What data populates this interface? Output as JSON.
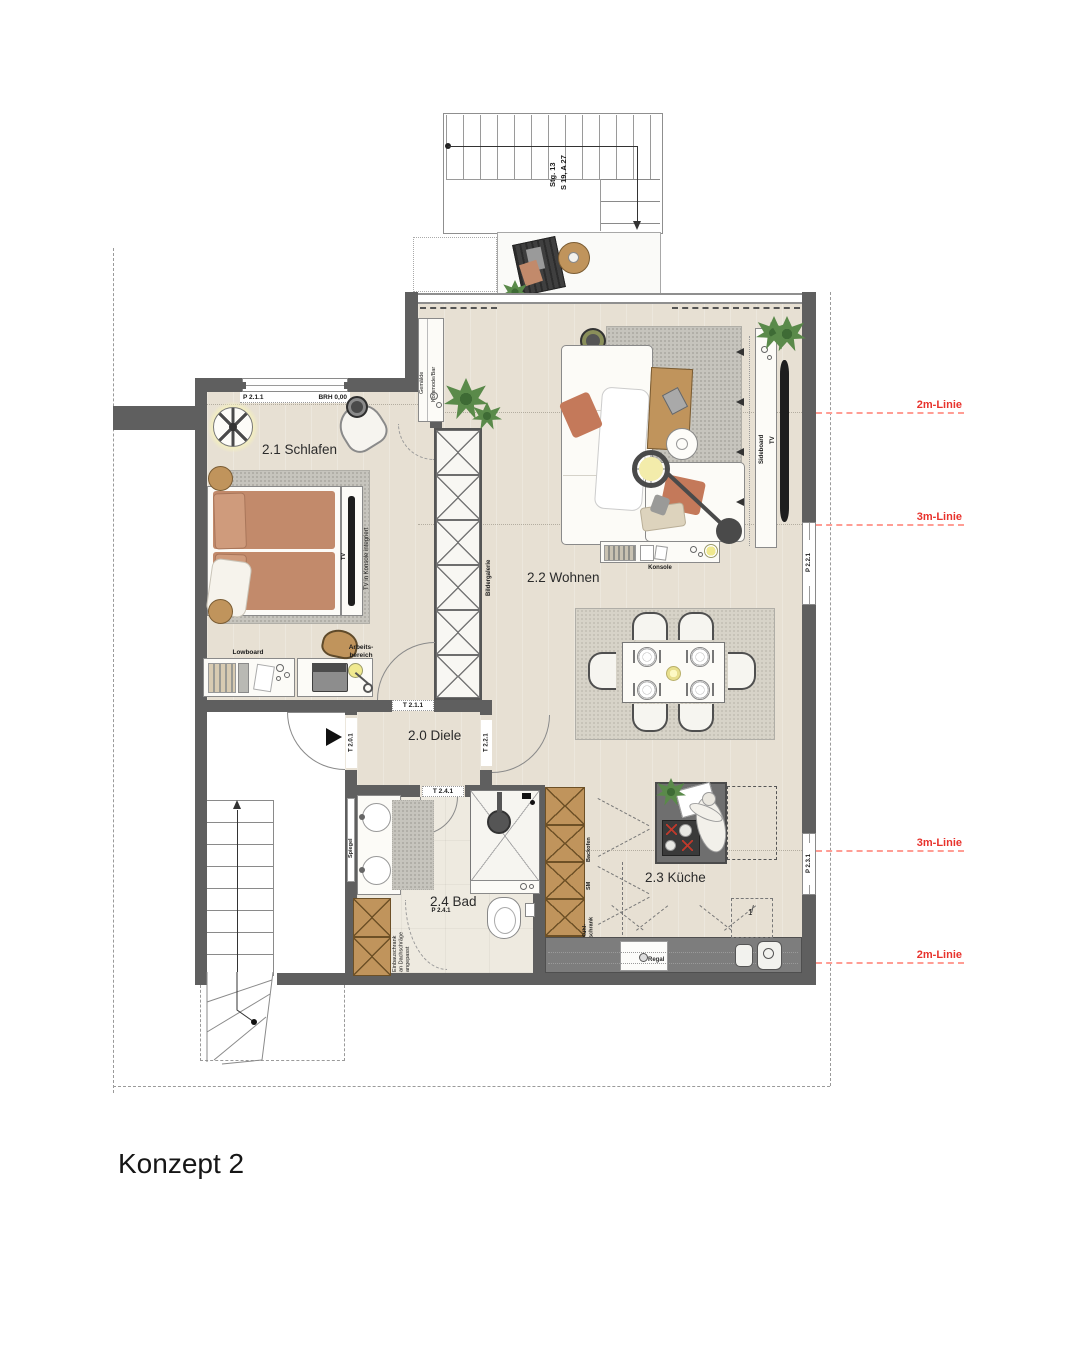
{
  "title": "Konzept 2",
  "rooms": {
    "schlafen": "2.1 Schlafen",
    "wohnen": "2.2 Wohnen",
    "diele": "2.0 Diele",
    "bad": "2.4 Bad",
    "kueche": "2.3 Küche"
  },
  "doors": {
    "t201": "T 2.0.1",
    "t211": "T 2.1.1",
    "t221": "T 2.2.1",
    "t241": "T 2.4.1"
  },
  "windows": {
    "p211": "P 2.1.1",
    "brh": "BRH 0,00",
    "p221": "P 2.2.1",
    "p231": "P 2.3.1",
    "p241": "P 2.4.1"
  },
  "stair": {
    "line1": "Stg. 13",
    "line2": "S 19, A 27"
  },
  "furniture": {
    "lowboard": "Lowboard",
    "arbeitsbereich": "Arbeits-\nbereich",
    "tv": "TV",
    "tv_wand": "TV",
    "tv_konsole": "TV in Konsole integriert",
    "bildergalerie": "Bildergalerie",
    "gemaelde": "Gemälde",
    "kommode_bar": "Kommode/Bar",
    "sideboard": "Sideboard",
    "konsole": "Konsole",
    "spiegel": "Spiegel",
    "regal": "Regal",
    "backofen": "Backofen",
    "sm": "SM",
    "kuehlschrank": "Kühl-\nschrank",
    "einbauschrank": "Einbauschrank\nan Dachschräge\nangepasst",
    "marker1": "1"
  },
  "height_lines": [
    {
      "label": "2m-Linie"
    },
    {
      "label": "3m-Linie"
    },
    {
      "label": "3m-Linie"
    },
    {
      "label": "2m-Linie"
    }
  ],
  "colors": {
    "wall": "#5f5f5f",
    "floor": "#e7e0d3",
    "bathfloor": "#eeeae0",
    "wood": "#c0945c",
    "bed": "#c28a6b",
    "red": "#e8322c",
    "plant": "#5a8a4a"
  }
}
